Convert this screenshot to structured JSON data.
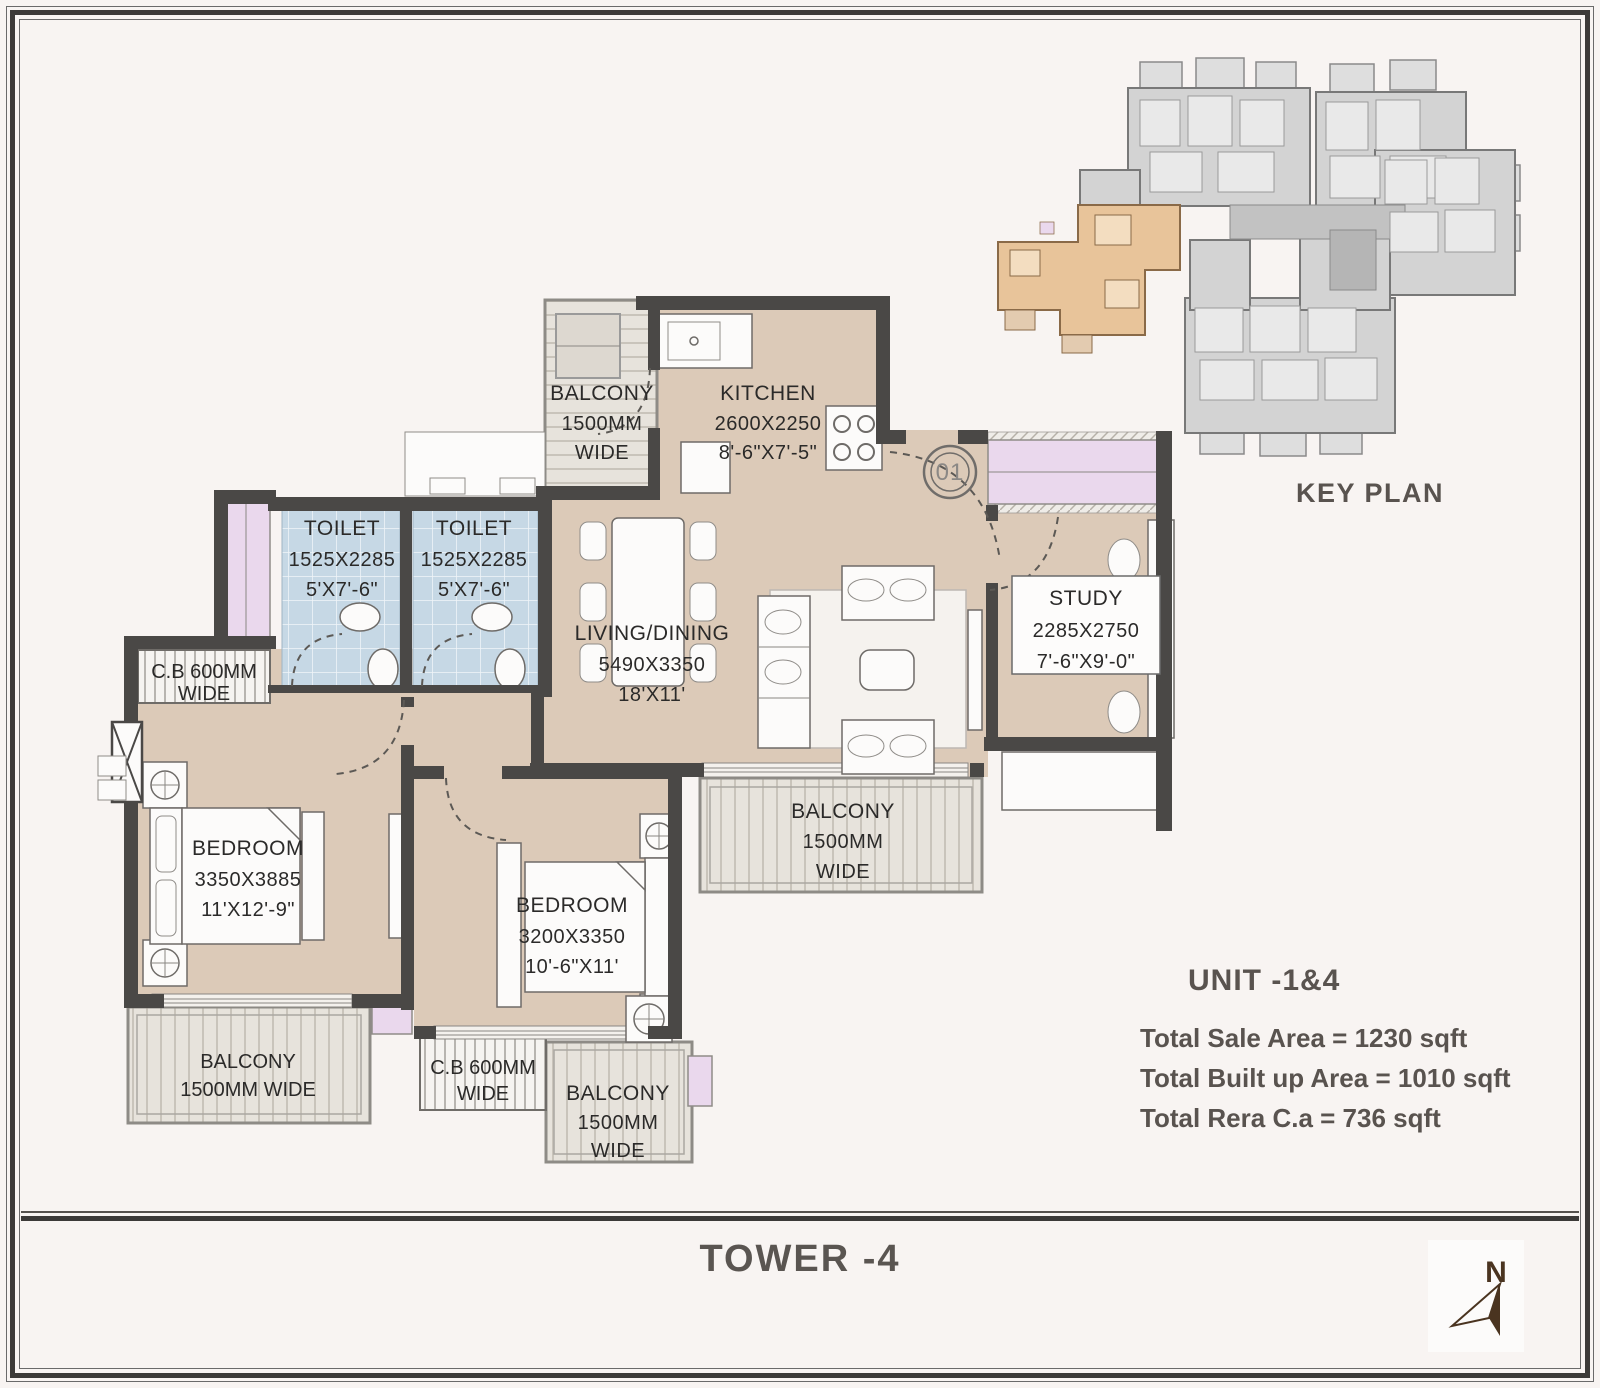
{
  "rooms": {
    "kitchen": {
      "name": "KITCHEN",
      "mm": "2600X2250",
      "ft": "8'-6\"X7'-5\""
    },
    "toilet1": {
      "name": "TOILET",
      "mm": "1525X2285",
      "ft": "5'X7'-6\""
    },
    "toilet2": {
      "name": "TOILET",
      "mm": "1525X2285",
      "ft": "5'X7'-6\""
    },
    "living": {
      "name": "LIVING/DINING",
      "mm": "5490X3350",
      "ft": "18'X11'"
    },
    "study": {
      "name": "STUDY",
      "mm": "2285X2750",
      "ft": "7'-6\"X9'-0\""
    },
    "bedroom1": {
      "name": "BEDROOM",
      "mm": "3350X3885",
      "ft": "11'X12'-9\""
    },
    "bedroom2": {
      "name": "BEDROOM",
      "mm": "3200X3350",
      "ft": "10'-6\"X11'"
    }
  },
  "balconies": {
    "kitchen": {
      "l1": "BALCONY",
      "l2": "1500MM",
      "l3": "WIDE"
    },
    "living": {
      "l1": "BALCONY",
      "l2": "1500MM",
      "l3": "WIDE"
    },
    "master": {
      "l1": "BALCONY",
      "l2": "1500MM WIDE"
    },
    "bottom": {
      "l1": "BALCONY",
      "l2": "1500MM",
      "l3": "WIDE"
    }
  },
  "cupboards": {
    "left": {
      "l1": "C.B 600MM",
      "l2": "WIDE"
    },
    "bottom": {
      "l1": "C.B 600MM",
      "l2": "WIDE"
    }
  },
  "entry": {
    "number": "01"
  },
  "key_plan": {
    "label": "KEY PLAN"
  },
  "unit_info": {
    "title": "UNIT -1&4",
    "sale": "Total Sale Area = 1230 sqft",
    "built": "Total Built up Area = 1010 sqft",
    "rera": "Total Rera C.a = 736 sqft"
  },
  "footer": {
    "tower": "TOWER -4"
  },
  "compass": {
    "label": "N"
  },
  "colors": {
    "wall": "#4a4846",
    "floor": "#dccab8",
    "toilet_floor": "#c6d8e5",
    "balcony_floor": "#e7e3dc",
    "window": "#ead8ed",
    "keyplan_unit_highlight": "#e8c49a",
    "keyplan_block": "#d3d3d3",
    "heading_text": "#59534f",
    "compass_needle": "#4a3420"
  }
}
